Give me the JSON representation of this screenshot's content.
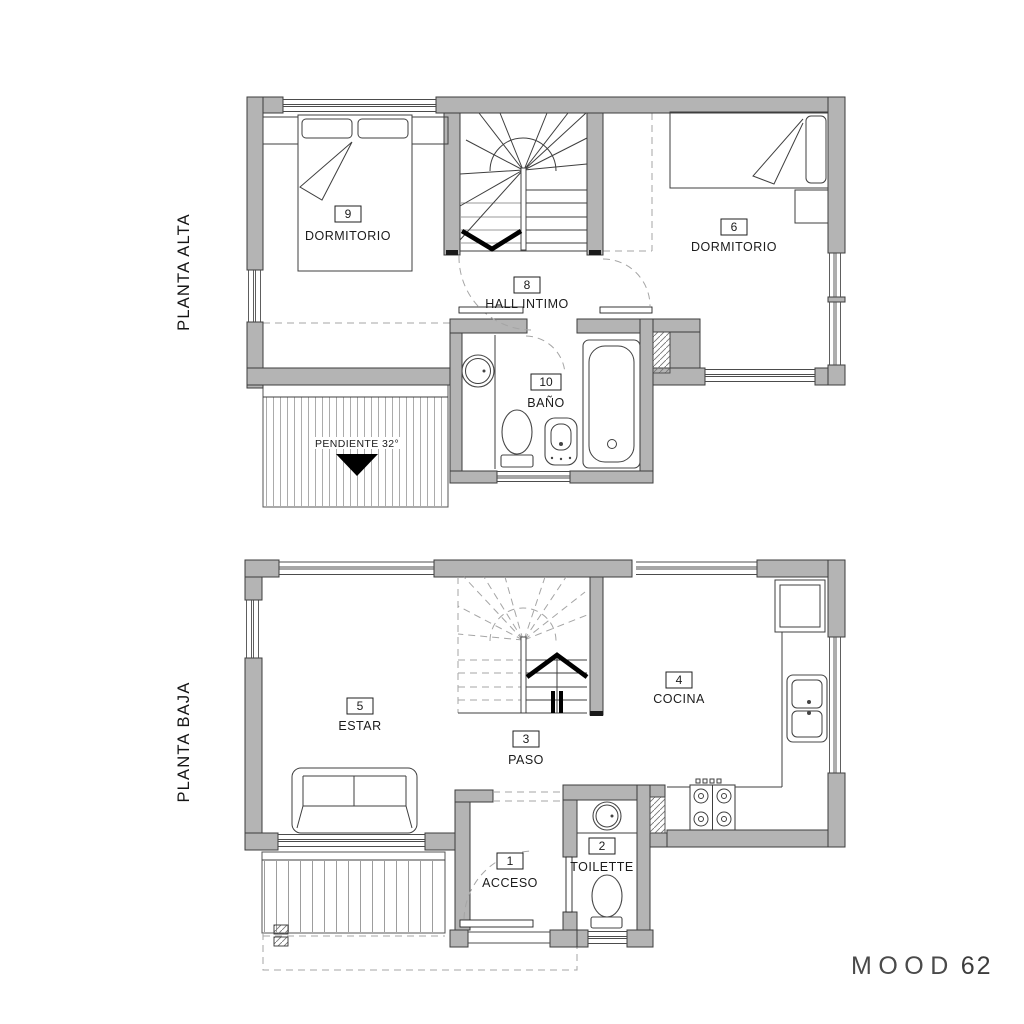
{
  "side_labels": {
    "upper": "PLANTA ALTA",
    "lower": "PLANTA BAJA"
  },
  "floors": {
    "alta": {
      "label": "PLANTA ALTA",
      "rooms": [
        {
          "number": "9",
          "name": "DORMITORIO"
        },
        {
          "number": "6",
          "name": "DORMITORIO"
        },
        {
          "number": "8",
          "name": "HALL INTIMO"
        },
        {
          "number": "10",
          "name": "BAÑO"
        }
      ],
      "roof_note": {
        "text": "PENDIENTE 32°"
      }
    },
    "baja": {
      "label": "PLANTA BAJA",
      "rooms": [
        {
          "number": "5",
          "name": "ESTAR"
        },
        {
          "number": "3",
          "name": "PASO"
        },
        {
          "number": "4",
          "name": "COCINA"
        },
        {
          "number": "1",
          "name": "ACCESO"
        },
        {
          "number": "2",
          "name": "TOILETTE"
        }
      ]
    }
  },
  "logo": {
    "word": "MOOD",
    "number": "62"
  },
  "colors": {
    "background": "#ffffff",
    "wall_fill": "#b4b4b4",
    "wall_stroke": "#3d3d3d",
    "line": "#3f3f3f",
    "dashed": "#a5a5a5",
    "black": "#000000"
  }
}
